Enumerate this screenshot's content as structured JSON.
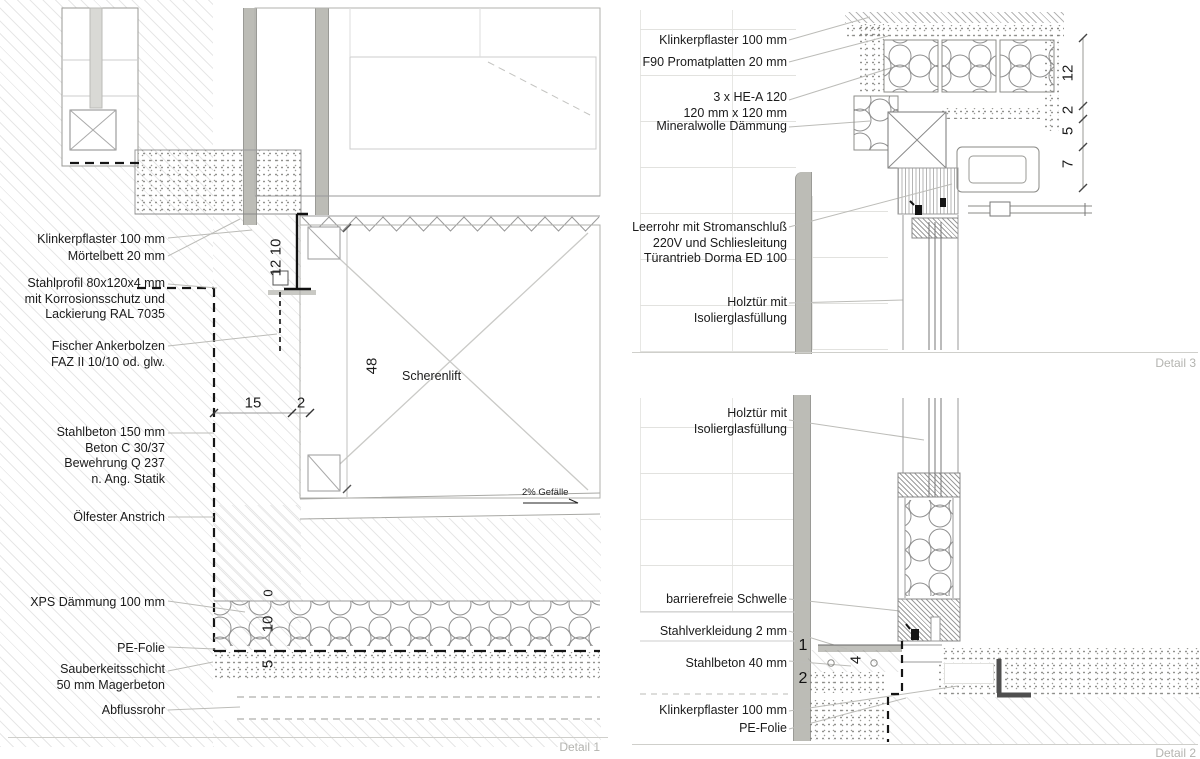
{
  "detail1": {
    "caption": "Detail 1",
    "labels": [
      {
        "lines": [
          "Klinkerpflaster 100 mm"
        ]
      },
      {
        "lines": [
          "Mörtelbett 20 mm"
        ]
      },
      {
        "lines": [
          "Stahlprofil 80x120x4 mm",
          "mit Korrosionsschutz und",
          "Lackierung RAL 7035"
        ]
      },
      {
        "lines": [
          "Fischer Ankerbolzen",
          "FAZ II 10/10 od. glw."
        ]
      },
      {
        "lines": [
          "Stahlbeton 150 mm",
          "Beton C 30/37",
          "Bewehrung Q 237",
          "n. Ang. Statik"
        ]
      },
      {
        "lines": [
          "Ölfester Anstrich"
        ]
      },
      {
        "lines": [
          "XPS Dämmung 100 mm"
        ]
      },
      {
        "lines": [
          "PE-Folie"
        ]
      },
      {
        "lines": [
          "Sauberkeitsschicht",
          "50 mm Magerbeton"
        ]
      },
      {
        "lines": [
          "Abflussrohr"
        ]
      }
    ],
    "dims": {
      "klinker": "10",
      "profil": "12",
      "pit_depth": "48",
      "ledge": "15",
      "ledge2": "2",
      "zero": "0",
      "xps": "10",
      "sauberkeit": "5"
    },
    "annotations": {
      "lift": "Scherenlift",
      "slope": "2% Gefälle"
    }
  },
  "detail3": {
    "caption": "Detail 3",
    "labels": [
      {
        "lines": [
          "Klinkerpflaster 100 mm"
        ]
      },
      {
        "lines": [
          "F90 Promatplatten 20 mm"
        ]
      },
      {
        "lines": [
          "3 x HE-A 120",
          "120 mm x 120 mm"
        ]
      },
      {
        "lines": [
          "Mineralwolle Dämmung"
        ]
      },
      {
        "lines": [
          "Leerrohr mit Stromanschluß",
          "220V und Schliesleitung",
          "Türantrieb Dorma ED 100"
        ]
      },
      {
        "lines": [
          "Holztür mit",
          "Isolierglasfüllung"
        ]
      }
    ],
    "dims": [
      "12",
      "2",
      "5",
      "7"
    ]
  },
  "detail2": {
    "caption": "Detail 2",
    "labels": [
      {
        "lines": [
          "Holztür mit",
          "Isolierglasfüllung"
        ]
      },
      {
        "lines": [
          "barrierefreie Schwelle"
        ]
      },
      {
        "lines": [
          "Stahlverkleidung 2 mm"
        ]
      },
      {
        "lines": [
          "Stahlbeton 40 mm"
        ]
      },
      {
        "lines": [
          "Klinkerpflaster 100 mm"
        ]
      },
      {
        "lines": [
          "PE-Folie"
        ]
      }
    ],
    "markers": {
      "m1": "1",
      "m2": "2",
      "m4": "4"
    }
  },
  "colors": {
    "heavy_line": "#151515",
    "leader_gray": "#bcbcb8",
    "caption_gray": "#b4b4b0",
    "bar_gray": "#bcbcb6"
  }
}
